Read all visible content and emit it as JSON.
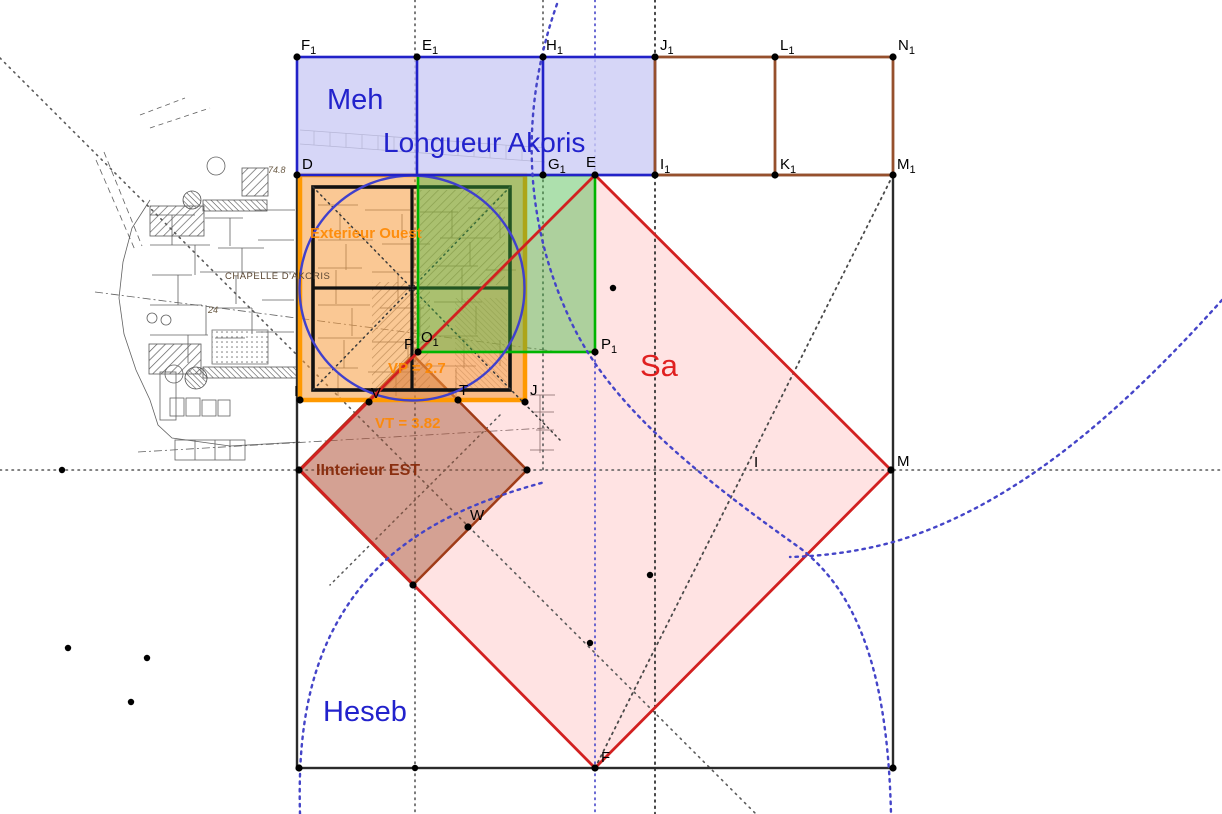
{
  "region_labels": {
    "meh": "Meh",
    "longueur": "Longueur Akoris",
    "sa": "Sa",
    "heseb": "Heseb",
    "ext_ouest": "Exterieur Ouest",
    "int_est": "IInterieur EST",
    "vt": "VT = 3.82",
    "vp": "VP = 2.7"
  },
  "plan_labels": {
    "chapelle": "CHAPELLE D'AKORIS",
    "n24": "24",
    "n748": "74.8"
  },
  "points": {
    "F1": {
      "base": "F",
      "sub": "1"
    },
    "E1": {
      "base": "E",
      "sub": "1"
    },
    "H1": {
      "base": "H",
      "sub": "1"
    },
    "J1": {
      "base": "J",
      "sub": "1"
    },
    "L1": {
      "base": "L",
      "sub": "1"
    },
    "N1": {
      "base": "N",
      "sub": "1"
    },
    "D": {
      "base": "D"
    },
    "G1": {
      "base": "G",
      "sub": "1"
    },
    "E": {
      "base": "E"
    },
    "I1": {
      "base": "I",
      "sub": "1"
    },
    "K1": {
      "base": "K",
      "sub": "1"
    },
    "M1": {
      "base": "M",
      "sub": "1"
    },
    "I_orange": {
      "base": "I"
    },
    "V": {
      "base": "V"
    },
    "T": {
      "base": "T"
    },
    "J": {
      "base": "J"
    },
    "P": {
      "base": "P"
    },
    "O1": {
      "base": "O",
      "sub": "1"
    },
    "P1": {
      "base": "P",
      "sub": "1"
    },
    "M": {
      "base": "M"
    },
    "F": {
      "base": "F"
    },
    "W": {
      "base": "W"
    },
    "I_line": {
      "base": "I"
    }
  },
  "colors": {
    "navy": "#2222c8",
    "lavender": "#ccccf5",
    "brown": "#96502d",
    "orange": "#ff9900",
    "orange_fill": "#f59a3c",
    "green": "#00b400",
    "green_fill": "#3cb43c",
    "red": "#d22020",
    "red_fill": "#ff8080",
    "dbrown": "#a03c18",
    "dbrown_fill": "#a05030",
    "circle_blue": "#4040cc",
    "dot_gray": "#595959",
    "dot_blue": "#4444c8",
    "text_blue": "#2222cc",
    "text_red": "#e02020",
    "text_orange": "#ff8800",
    "text_brown": "#8a2f10",
    "plan_ink": "#3a3a3a",
    "black": "#2b2b2b"
  }
}
